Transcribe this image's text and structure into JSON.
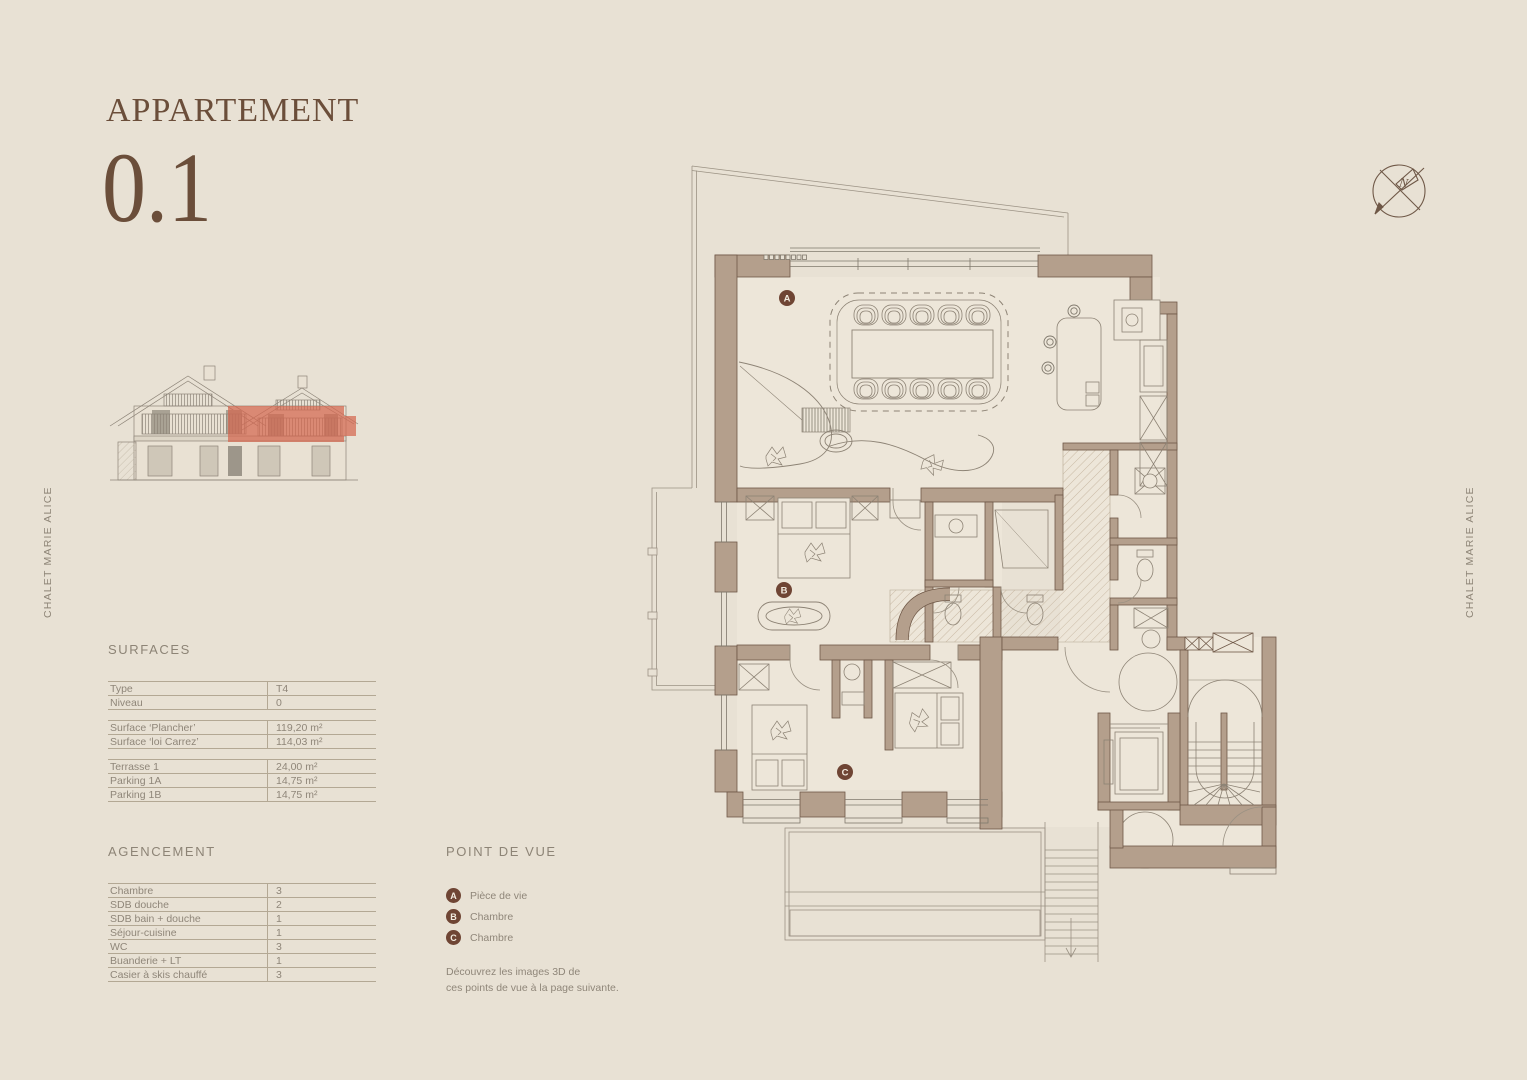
{
  "page": {
    "background": "#e8e1d4",
    "accent_red": "#d4674f",
    "ink_brown": "#6b4e3a",
    "wall_tan": "#b49f8c",
    "text_gray": "#8f8679"
  },
  "title": {
    "label": "APPARTEMENT",
    "number": "0.1"
  },
  "side_label_left": "CHALET MARIE ALICE",
  "side_label_right": "CHALET MARIE ALICE",
  "compass": {
    "north_letter": "N"
  },
  "surfaces": {
    "heading": "SURFACES",
    "rows": [
      {
        "label": "Type",
        "value": "T4"
      },
      {
        "label": "Niveau",
        "value": "0"
      },
      {
        "label": "Surface ‘Plancher’",
        "value": "119,20 m²"
      },
      {
        "label": "Surface ‘loi Carrez’",
        "value": "114,03 m²"
      },
      {
        "label": "Terrasse 1",
        "value": "24,00 m²"
      },
      {
        "label": "Parking 1A",
        "value": "14,75 m²"
      },
      {
        "label": "Parking 1B",
        "value": "14,75 m²"
      }
    ]
  },
  "agencement": {
    "heading": "AGENCEMENT",
    "rows": [
      {
        "label": "Chambre",
        "value": "3"
      },
      {
        "label": "SDB douche",
        "value": "2"
      },
      {
        "label": "SDB bain + douche",
        "value": "1"
      },
      {
        "label": "Séjour-cuisine",
        "value": "1"
      },
      {
        "label": "WC",
        "value": "3"
      },
      {
        "label": "Buanderie + LT",
        "value": "1"
      },
      {
        "label": "Casier à skis chauffé",
        "value": "3"
      }
    ]
  },
  "point_de_vue": {
    "heading": "POINT DE VUE",
    "items": [
      {
        "badge": "A",
        "label": "Pièce de vie"
      },
      {
        "badge": "B",
        "label": "Chambre"
      },
      {
        "badge": "C",
        "label": "Chambre"
      }
    ],
    "note_line1": "Découvrez les images 3D de",
    "note_line2": "ces points de vue à la page suivante."
  },
  "plan_markers": {
    "a": "A",
    "b": "B",
    "c": "C"
  }
}
